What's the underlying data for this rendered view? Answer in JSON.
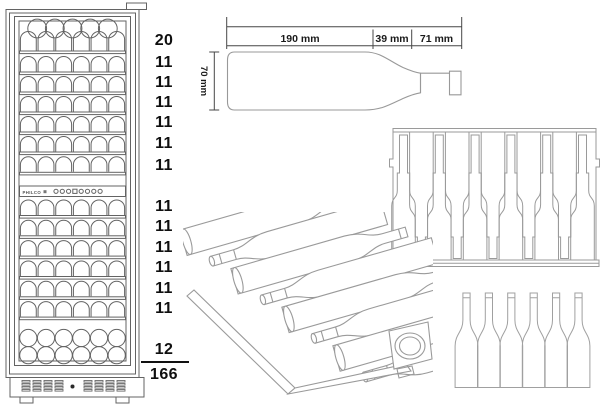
{
  "brand": "PHILCO",
  "capacity": {
    "upper_shelf_counts": [
      "20",
      "11",
      "11",
      "11",
      "11",
      "11",
      "11"
    ],
    "lower_shelf_counts": [
      "11",
      "11",
      "11",
      "11",
      "11",
      "11"
    ],
    "bottom_count": "12",
    "total": "166"
  },
  "bottle_dimensions": {
    "length_body": "190 mm",
    "length_shoulder": "39 mm",
    "length_neck": "71 mm",
    "diameter": "70 mm"
  },
  "counts": {
    "top_section_circles": 5,
    "arches_per_shelf": 6,
    "upper_shelf_rows": 6,
    "lower_shelf_rows": 6,
    "bottom_circle_rows": 2,
    "bottom_circles_per_row": 6,
    "tray_bottles": 11,
    "rack_bottles": 8,
    "standing_bottles": 6
  },
  "control_panel": {
    "indicators": [
      "circle",
      "circle",
      "circle",
      "square",
      "circle",
      "circle",
      "circle",
      "circle"
    ]
  },
  "colors": {
    "fridge_line": "#636363",
    "drawing_line": "#9a9a9a",
    "dim_line": "#474747",
    "text": "#0f0f0f",
    "background": "#ffffff"
  }
}
